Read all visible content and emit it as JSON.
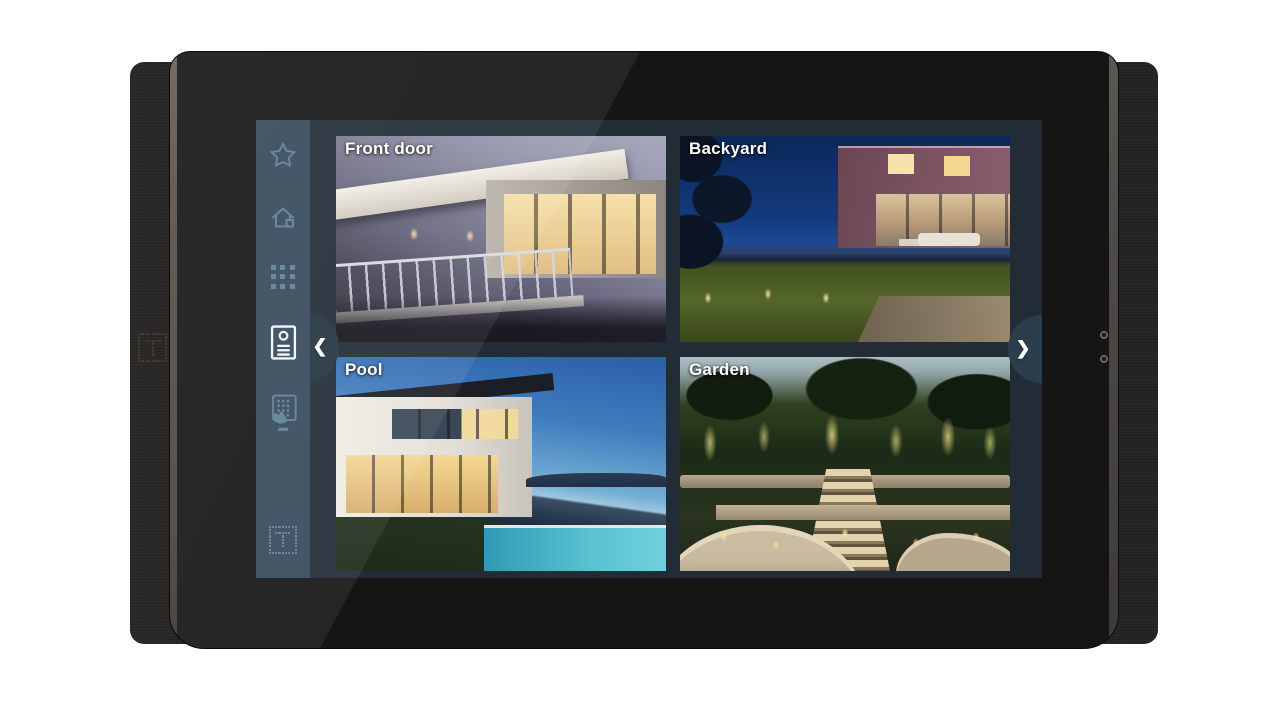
{
  "device": {
    "brand_mark": "dot-matrix-T-logo"
  },
  "screen": {
    "sidebar": {
      "items": [
        {
          "name": "favorites",
          "icon": "star-icon",
          "active": false
        },
        {
          "name": "home",
          "icon": "home-icon",
          "active": false
        },
        {
          "name": "apps",
          "icon": "apps-grid-icon",
          "active": false
        },
        {
          "name": "door-station",
          "icon": "door-station-icon",
          "active": true
        },
        {
          "name": "door-keypad",
          "icon": "keypad-hand-icon",
          "active": false
        },
        {
          "name": "brand",
          "icon": "dot-matrix-logo-icon",
          "active": false
        }
      ]
    },
    "cameras": [
      {
        "name": "Front door"
      },
      {
        "name": "Backyard"
      },
      {
        "name": "Pool"
      },
      {
        "name": "Garden"
      }
    ],
    "nav": {
      "prev": "❮",
      "next": "❯"
    },
    "colors": {
      "sidebar": "#36495A",
      "panel": "#212C37",
      "icon": "#5E8096",
      "active_icon": "#F3F6F8",
      "nav_circle_left": "#233440",
      "nav_circle_right": "#2B3E4C"
    }
  }
}
